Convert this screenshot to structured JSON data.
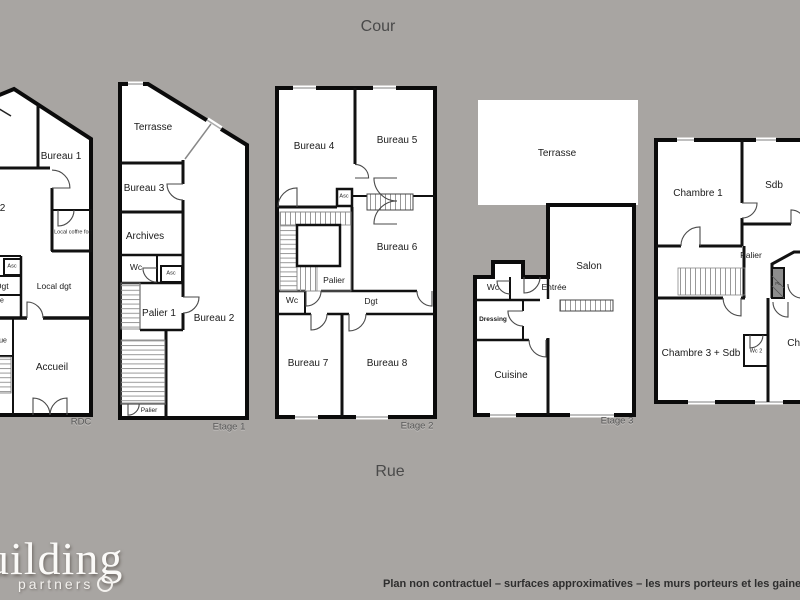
{
  "page": {
    "orientation": {
      "top": "Cour",
      "bottom": "Rue"
    },
    "disclaimer": "Plan non contractuel – surfaces approximatives – les murs porteurs et les gaines techniques",
    "logo": {
      "word": "building",
      "sub": "partners"
    },
    "colors": {
      "background": "#a8a5a2",
      "wall": "#0d0d0d",
      "room_fill": "#ffffff",
      "room_label": "#1b1b1b",
      "floor_label": "#5a5a5a",
      "stair_hatch": "#999999",
      "logo_text": "#fbfaf8",
      "disclaimer_text": "#2e2e2e"
    }
  },
  "floors": [
    {
      "floor_label": "RDC",
      "rooms": {
        "bureau_1": "Bureau 1",
        "bureau_2": "Bureau 2",
        "local_coffre_fort": "Local coffre fort",
        "asc": "Asc",
        "dgt": "Dgt",
        "fragment_e": "e",
        "local_dgt": "Local dgt",
        "fragment_ue": "ue",
        "accueil": "Accueil"
      }
    },
    {
      "floor_label": "Etage 1",
      "rooms": {
        "terrasse": "Terrasse",
        "bureau_3": "Bureau 3",
        "archives": "Archives",
        "wc": "Wc",
        "asc": "Asc",
        "palier_1": "Palier 1",
        "bureau_2": "Bureau 2",
        "palier": "Palier"
      }
    },
    {
      "floor_label": "Etage 2",
      "rooms": {
        "bureau_4": "Bureau 4",
        "bureau_5": "Bureau 5",
        "asc": "Asc",
        "bureau_6": "Bureau 6",
        "palier": "Palier",
        "wc": "Wc",
        "dgt": "Dgt",
        "bureau_7": "Bureau 7",
        "bureau_8": "Bureau 8"
      }
    },
    {
      "floor_label": "Etage 3",
      "rooms": {
        "terrasse": "Terrasse",
        "salon": "Salon",
        "wc": "Wc",
        "entree": "Entrée",
        "dressing": "Dressing",
        "cuisine": "Cuisine"
      }
    },
    {
      "rooms": {
        "chambre_1": "Chambre 1",
        "sdb": "Sdb",
        "palier": "Palier",
        "pl": "PL",
        "chambre_3_sdb": "Chambre 3 + Sdb",
        "wc_2": "Wc 2",
        "chambre_2": "Chambre 2"
      }
    }
  ]
}
